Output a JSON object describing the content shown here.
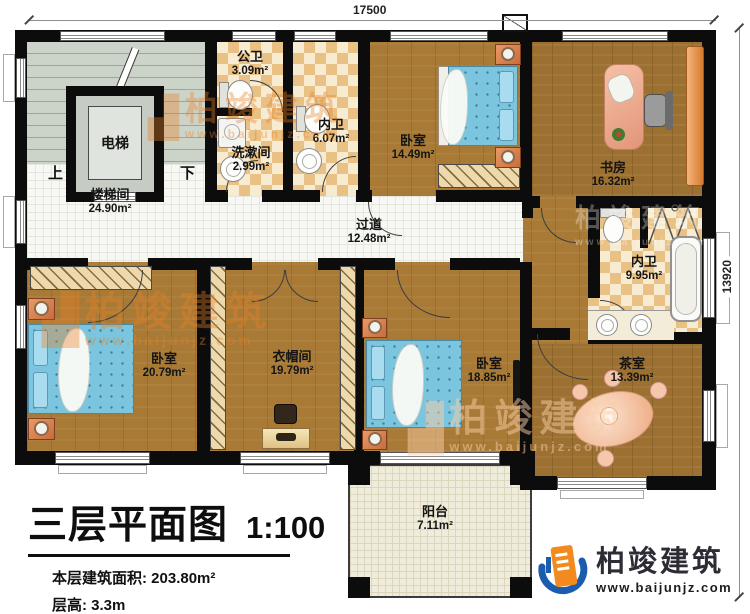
{
  "title_block": {
    "plan_title": "三层平面图",
    "scale": "1:100",
    "area_label": "本层建筑面积:",
    "area_value": "203.80m²",
    "height_label": "层高:",
    "height_value": "3.3m"
  },
  "dimensions": {
    "width_mm": "17500",
    "height_mm": "13920"
  },
  "rooms": {
    "stairwell": {
      "name": "楼梯间",
      "area": "24.90m²"
    },
    "elevator": {
      "name": "电梯"
    },
    "up": {
      "name": "上"
    },
    "down": {
      "name": "下"
    },
    "public_bath": {
      "name": "公卫",
      "area": "3.09m²"
    },
    "washroom": {
      "name": "洗漱间",
      "area": "2.99m²"
    },
    "ensuite_small": {
      "name": "内卫",
      "area": "6.07m²"
    },
    "bedroom_north": {
      "name": "卧室",
      "area": "14.49m²"
    },
    "study": {
      "name": "书房",
      "area": "16.32m²"
    },
    "corridor": {
      "name": "过道",
      "area": "12.48m²"
    },
    "ensuite_large": {
      "name": "内卫",
      "area": "9.95m²"
    },
    "bedroom_west": {
      "name": "卧室",
      "area": "20.79m²"
    },
    "cloakroom": {
      "name": "衣帽间",
      "area": "19.79m²"
    },
    "bedroom_south": {
      "name": "卧室",
      "area": "18.85m²"
    },
    "tea_room": {
      "name": "茶室",
      "area": "13.39m²"
    },
    "balcony": {
      "name": "阳台",
      "area": "7.11m²"
    }
  },
  "watermark": {
    "brand": "柏竣建筑",
    "url": "www.baijunjz.com"
  },
  "logo": {
    "brand": "柏竣建筑",
    "url": "www.baijunjz.com",
    "blue": "#1b5cad",
    "orange": "#f28a1e"
  },
  "colors": {
    "wall": "#0c0c0c",
    "wood": "#a87a36",
    "tile": "#f7f7f4",
    "checker": "#e9c184",
    "stairs": "#ccd4ca",
    "bed": "#7cc5de",
    "balcony": "#f0ecdb"
  }
}
